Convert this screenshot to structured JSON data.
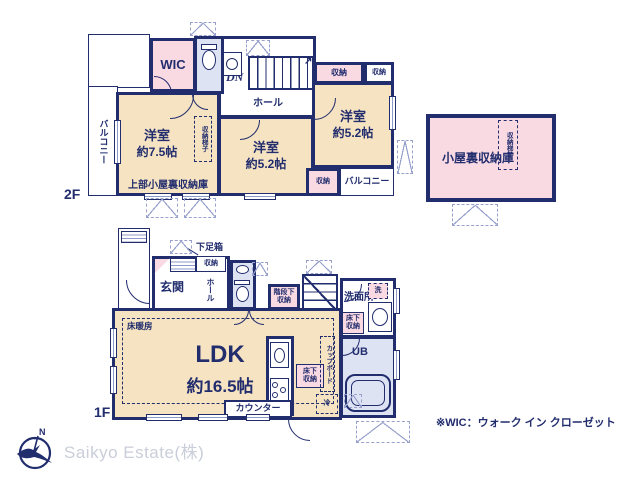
{
  "colors": {
    "wall_navy": "#222d6e",
    "room_beige": "#f5e3c1",
    "storage_pink": "#f9d9e2",
    "bath_lavender": "#dee3f4"
  },
  "f2": {
    "floor_label": "2F",
    "wic_label": "WIC",
    "dn_label": "DN",
    "stairs_arrow": "↗",
    "hall_label": "ホール",
    "storage_top_a": "収納",
    "storage_top_b": "収納",
    "storage_bottom": "収納",
    "room_left_name": "洋室",
    "room_left_size": "約7.5帖",
    "room_mid_name": "洋室",
    "room_mid_size": "約5.2帖",
    "room_right_name": "洋室",
    "room_right_size": "約5.2帖",
    "ladder_label": "収納梯子",
    "attic_above_label": "上部小屋裏収納庫",
    "balcony_left_label": "バルコニー",
    "balcony_right_label": "バルコニー"
  },
  "attic": {
    "name": "小屋裏収納庫",
    "ladder_label": "収納梯子"
  },
  "f1": {
    "floor_label": "1F",
    "shoebox_label": "下足箱",
    "entrance_label": "玄関",
    "hall_label": "ホール",
    "storage_label": "収納",
    "stair_storage_line1": "階段下",
    "stair_storage_line2": "収納",
    "up_label": "UP",
    "washroom_label": "洗面所",
    "washer_label": "洗",
    "underfloor_bath_line1": "床下",
    "underfloor_bath_line2": "収納",
    "ub_label": "UB",
    "floor_heating_label": "床暖房",
    "ldk_name": "LDK",
    "ldk_size": "約16.5帖",
    "counter_label": "カウンター",
    "underfloor_kitchen_line1": "床下",
    "underfloor_kitchen_line2": "収納",
    "cupboard_label": "カップボード",
    "fridge_label": "冷"
  },
  "footer": {
    "north_label": "N",
    "company_name": "Saikyo Estate(株)",
    "wic_note": "※WIC：ウォーク イン クローゼット"
  }
}
